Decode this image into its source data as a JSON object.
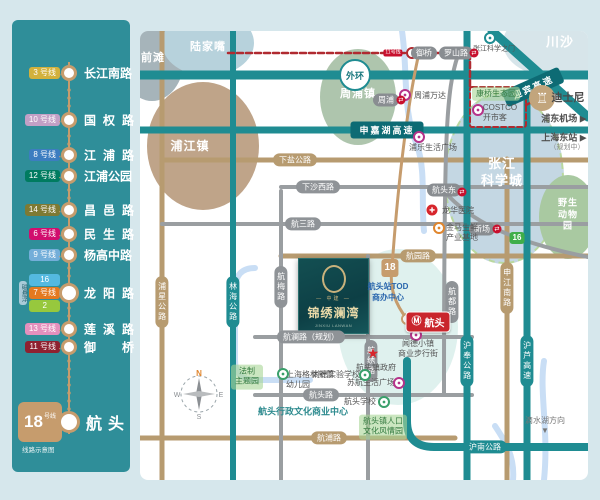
{
  "sidebar": {
    "arrow": "←",
    "footer": "线路示意图",
    "stations": [
      {
        "badges": [
          {
            "label": "3 号线",
            "color": "#d2b13c"
          }
        ],
        "name": "长江南路"
      },
      {
        "badges": [
          {
            "label": "10 号线",
            "color": "#c2a0c6"
          }
        ],
        "name": "国权路"
      },
      {
        "badges": [
          {
            "label": "8 号线",
            "color": "#3c7dc0"
          }
        ],
        "name": "江浦路"
      },
      {
        "badges": [
          {
            "label": "12 号线",
            "color": "#007b60"
          }
        ],
        "name": "江浦公园"
      },
      {
        "badges": [
          {
            "label": "14 号线",
            "color": "#7e7a33"
          }
        ],
        "name": "昌邑路"
      },
      {
        "badges": [
          {
            "label": "6 号线",
            "color": "#d10d6e"
          }
        ],
        "name": "民生路"
      },
      {
        "badges": [
          {
            "label": "9 号线",
            "color": "#73aed9"
          }
        ],
        "name": "杨高中路"
      },
      {
        "maglev": {
          "label": "磁悬浮",
          "color": "#aacbd8"
        },
        "stack": [
          {
            "label": "16",
            "color": "#54b9e0"
          },
          {
            "label": "7 号线",
            "color": "#e4791f"
          },
          {
            "label": "2",
            "color": "#97c83d"
          }
        ],
        "name": "龙阳路"
      },
      {
        "badges": [
          {
            "label": "13 号线",
            "color": "#e490bd"
          }
        ],
        "name": "莲溪路"
      },
      {
        "badges": [
          {
            "label": "11 号线",
            "color": "#8e2130"
          }
        ],
        "name": "御桥"
      }
    ],
    "terminal": {
      "number": "18",
      "suffix": "号线",
      "name": "航头"
    }
  },
  "map": {
    "areas": {
      "qiantan": "前滩",
      "lujiazui": "陆家嘴",
      "zhoupu_town": "周浦镇",
      "pujiang_town": "浦江镇",
      "zhangjiang": "张江\n科学城",
      "chuansha": "川沙",
      "wildlife_park": "野生\n动物园"
    },
    "roads": {
      "waihuan": "外环",
      "shenjiahu": "申嘉湖高速",
      "yingbin": "迎宾高速",
      "xiayan": "下盐公路",
      "xiashaxi": "下沙西路",
      "hangsan": "航三路",
      "hangyuan": "航园路",
      "hanglan": "航澜路（规划）",
      "hangtou_rd": "航头路",
      "hangpu": "航浦路",
      "hunan": "沪南公路",
      "puxing": "浦星公路",
      "linhai": "林海公路",
      "hangmei": "航梅路",
      "hangxiu": "航绣路",
      "hangdu": "航都路",
      "hufeng": "沪奉公路",
      "shenjiangnan": "申江南路",
      "hulu": "沪芦高速"
    },
    "metro": {
      "line11_badge": "11号线",
      "yuqiao": "御桥",
      "luoshan": "罗山路",
      "zhoupu_station": "周浦",
      "hangtoudong": "航头东",
      "xinchang": "新场",
      "line16_badge": "16",
      "line18_badge": "18",
      "hangtou_station": "航头"
    },
    "pois": {
      "zhangjiang_gate": "张江科学之门",
      "zhoupu_wanda": "周浦万达",
      "kangqiao_park": "康桥生态园",
      "costco": "COSTCO\n开市客",
      "disney": "迪士尼",
      "pudong_airport": "浦东机场 ▶",
      "shanghai_east": "上海东站 ▶",
      "planning": "（规划中）",
      "pule_plaza": "浦乐生活广场",
      "longhua_hospital": "龙华医院",
      "jinma_base": "金马生鲜\n产业基地",
      "tod": "航头站TOD\n商办中心",
      "wende_town": "闻德小镇\n商业步行街",
      "gov": "航头镇政府",
      "suhang_plaza": "苏航生活广场",
      "gelin_kindergarten": "上海格林新蕾\n幼儿园",
      "shangde_school": "尚德实验学校",
      "hangtou_school": "航头学校",
      "culture_park": "航头镇人口\n文化风情园",
      "civic_center": "航头行政文化商业中心",
      "fazhi_park": "法制\n主题园",
      "dishui": "滴水湖方向\n▼"
    },
    "project": {
      "brand": "— 中建 —",
      "name": "锦绣澜湾",
      "sub": "JINXIU LANWAN"
    },
    "compass": {
      "n": "N",
      "e": "E",
      "s": "S",
      "w": "W"
    },
    "colors": {
      "teal_road": "#1f8c92",
      "tan_road": "#b79b70",
      "gray_road": "#9a9ea1",
      "metro18": "#c69c6d",
      "route_red": "#b02a30",
      "river": "#c9def5"
    }
  }
}
